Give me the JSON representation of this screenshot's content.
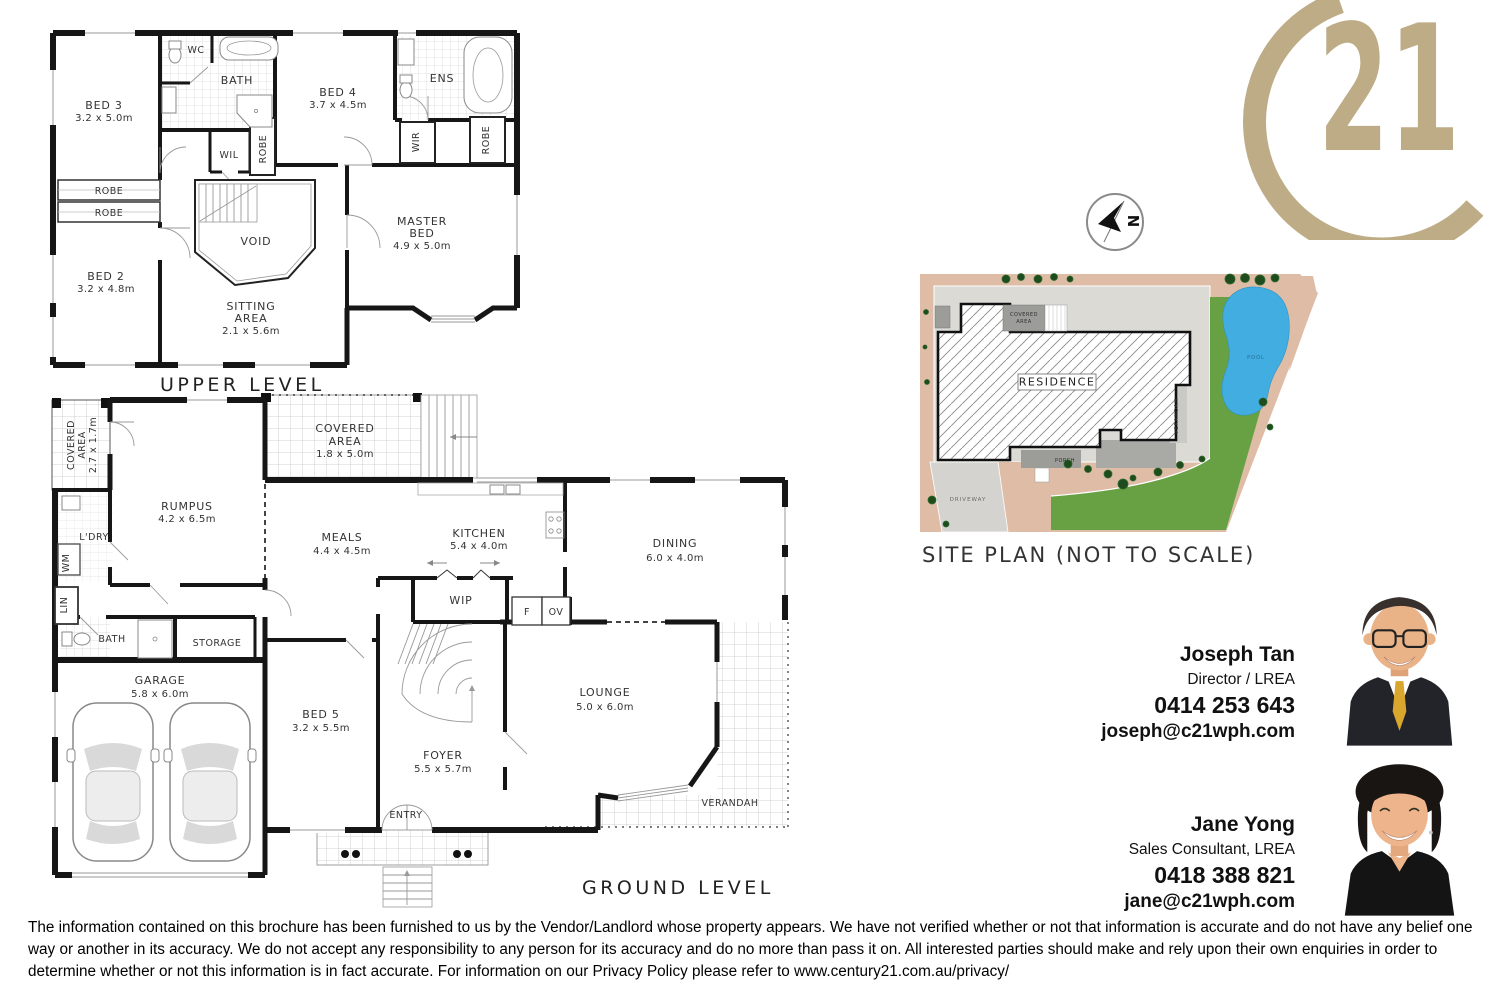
{
  "logo": {
    "number": "21",
    "gold": "#BDAC86"
  },
  "upper": {
    "title": "UPPER LEVEL",
    "bed3": {
      "name": "BED 3",
      "dims": "3.2 x 5.0m"
    },
    "wc": "WC",
    "bath": "BATH",
    "bed4": {
      "name": "BED 4",
      "dims": "3.7 x 4.5m"
    },
    "ens": "ENS",
    "wil": "WIL",
    "robe_mid": "ROBE",
    "wir": "WIR",
    "robe_right": "ROBE",
    "robe_shelf1": "ROBE",
    "robe_shelf2": "ROBE",
    "bed2": {
      "name": "BED 2",
      "dims": "3.2 x 4.8m"
    },
    "void": "VOID",
    "master": {
      "l1": "MASTER",
      "l2": "BED",
      "dims": "4.9 x 5.0m"
    },
    "sitting": {
      "l1": "SITTING",
      "l2": "AREA",
      "dims": "2.1 x 5.6m"
    }
  },
  "ground": {
    "title": "GROUND LEVEL",
    "covered_left": {
      "l1": "COVERED",
      "l2": "AREA",
      "dims": "2.7 x 1.7m"
    },
    "rumpus": {
      "name": "RUMPUS",
      "dims": "4.2 x 6.5m"
    },
    "covered_top": {
      "l1": "COVERED",
      "l2": "AREA",
      "dims": "1.8 x 5.0m"
    },
    "ldry": "L'DRY",
    "wm": "WM",
    "lin": "LIN",
    "meals": {
      "name": "MEALS",
      "dims": "4.4 x 4.5m"
    },
    "kitchen": {
      "name": "KITCHEN",
      "dims": "5.4 x 4.0m"
    },
    "dining": {
      "name": "DINING",
      "dims": "6.0 x 4.0m"
    },
    "wip": "WIP",
    "fridge": "F",
    "oven": "OV",
    "bath": "BATH",
    "storage": "STORAGE",
    "garage": {
      "name": "GARAGE",
      "dims": "5.8 x 6.0m"
    },
    "bed5": {
      "name": "BED 5",
      "dims": "3.2 x 5.5m"
    },
    "foyer": {
      "name": "FOYER",
      "dims": "5.5 x 5.7m"
    },
    "lounge": {
      "name": "LOUNGE",
      "dims": "5.0 x 6.0m"
    },
    "verandah": "VERANDAH",
    "entry": "ENTRY"
  },
  "site": {
    "title": "SITE PLAN (NOT TO SCALE)",
    "residence": "RESIDENCE",
    "covered": {
      "l1": "COVERED",
      "l2": "AREA"
    },
    "verandah": "VERANDAH",
    "porch": "PORCH",
    "driveway": "DRIVEWAY",
    "pool": "POOL",
    "colors": {
      "grass": "#68A144",
      "sand": "#DEBCA6",
      "path": "#DBDAD5",
      "pool_water": "#41ADE0",
      "covered_gray": "#9C9C99"
    }
  },
  "agents": [
    {
      "name": "Joseph Tan",
      "title": "Director / LREA",
      "phone": "0414 253 643",
      "email": "joseph@c21wph.com"
    },
    {
      "name": "Jane Yong",
      "title": "Sales Consultant, LREA",
      "phone": "0418 388 821",
      "email": "jane@c21wph.com"
    }
  ],
  "disclaimer": "The information contained on this brochure has been furnished to us by the Vendor/Landlord whose property appears. We have not verified whether or not that information is accurate and do not have any belief one way or another in its accuracy. We do not accept any responsibility to any person for its accuracy and do no more than pass it on. All interested parties should make and rely upon their own enquiries in order to determine whether or not this information is in fact accurate. For information on our Privacy Policy please refer to www.century21.com.au/privacy/"
}
